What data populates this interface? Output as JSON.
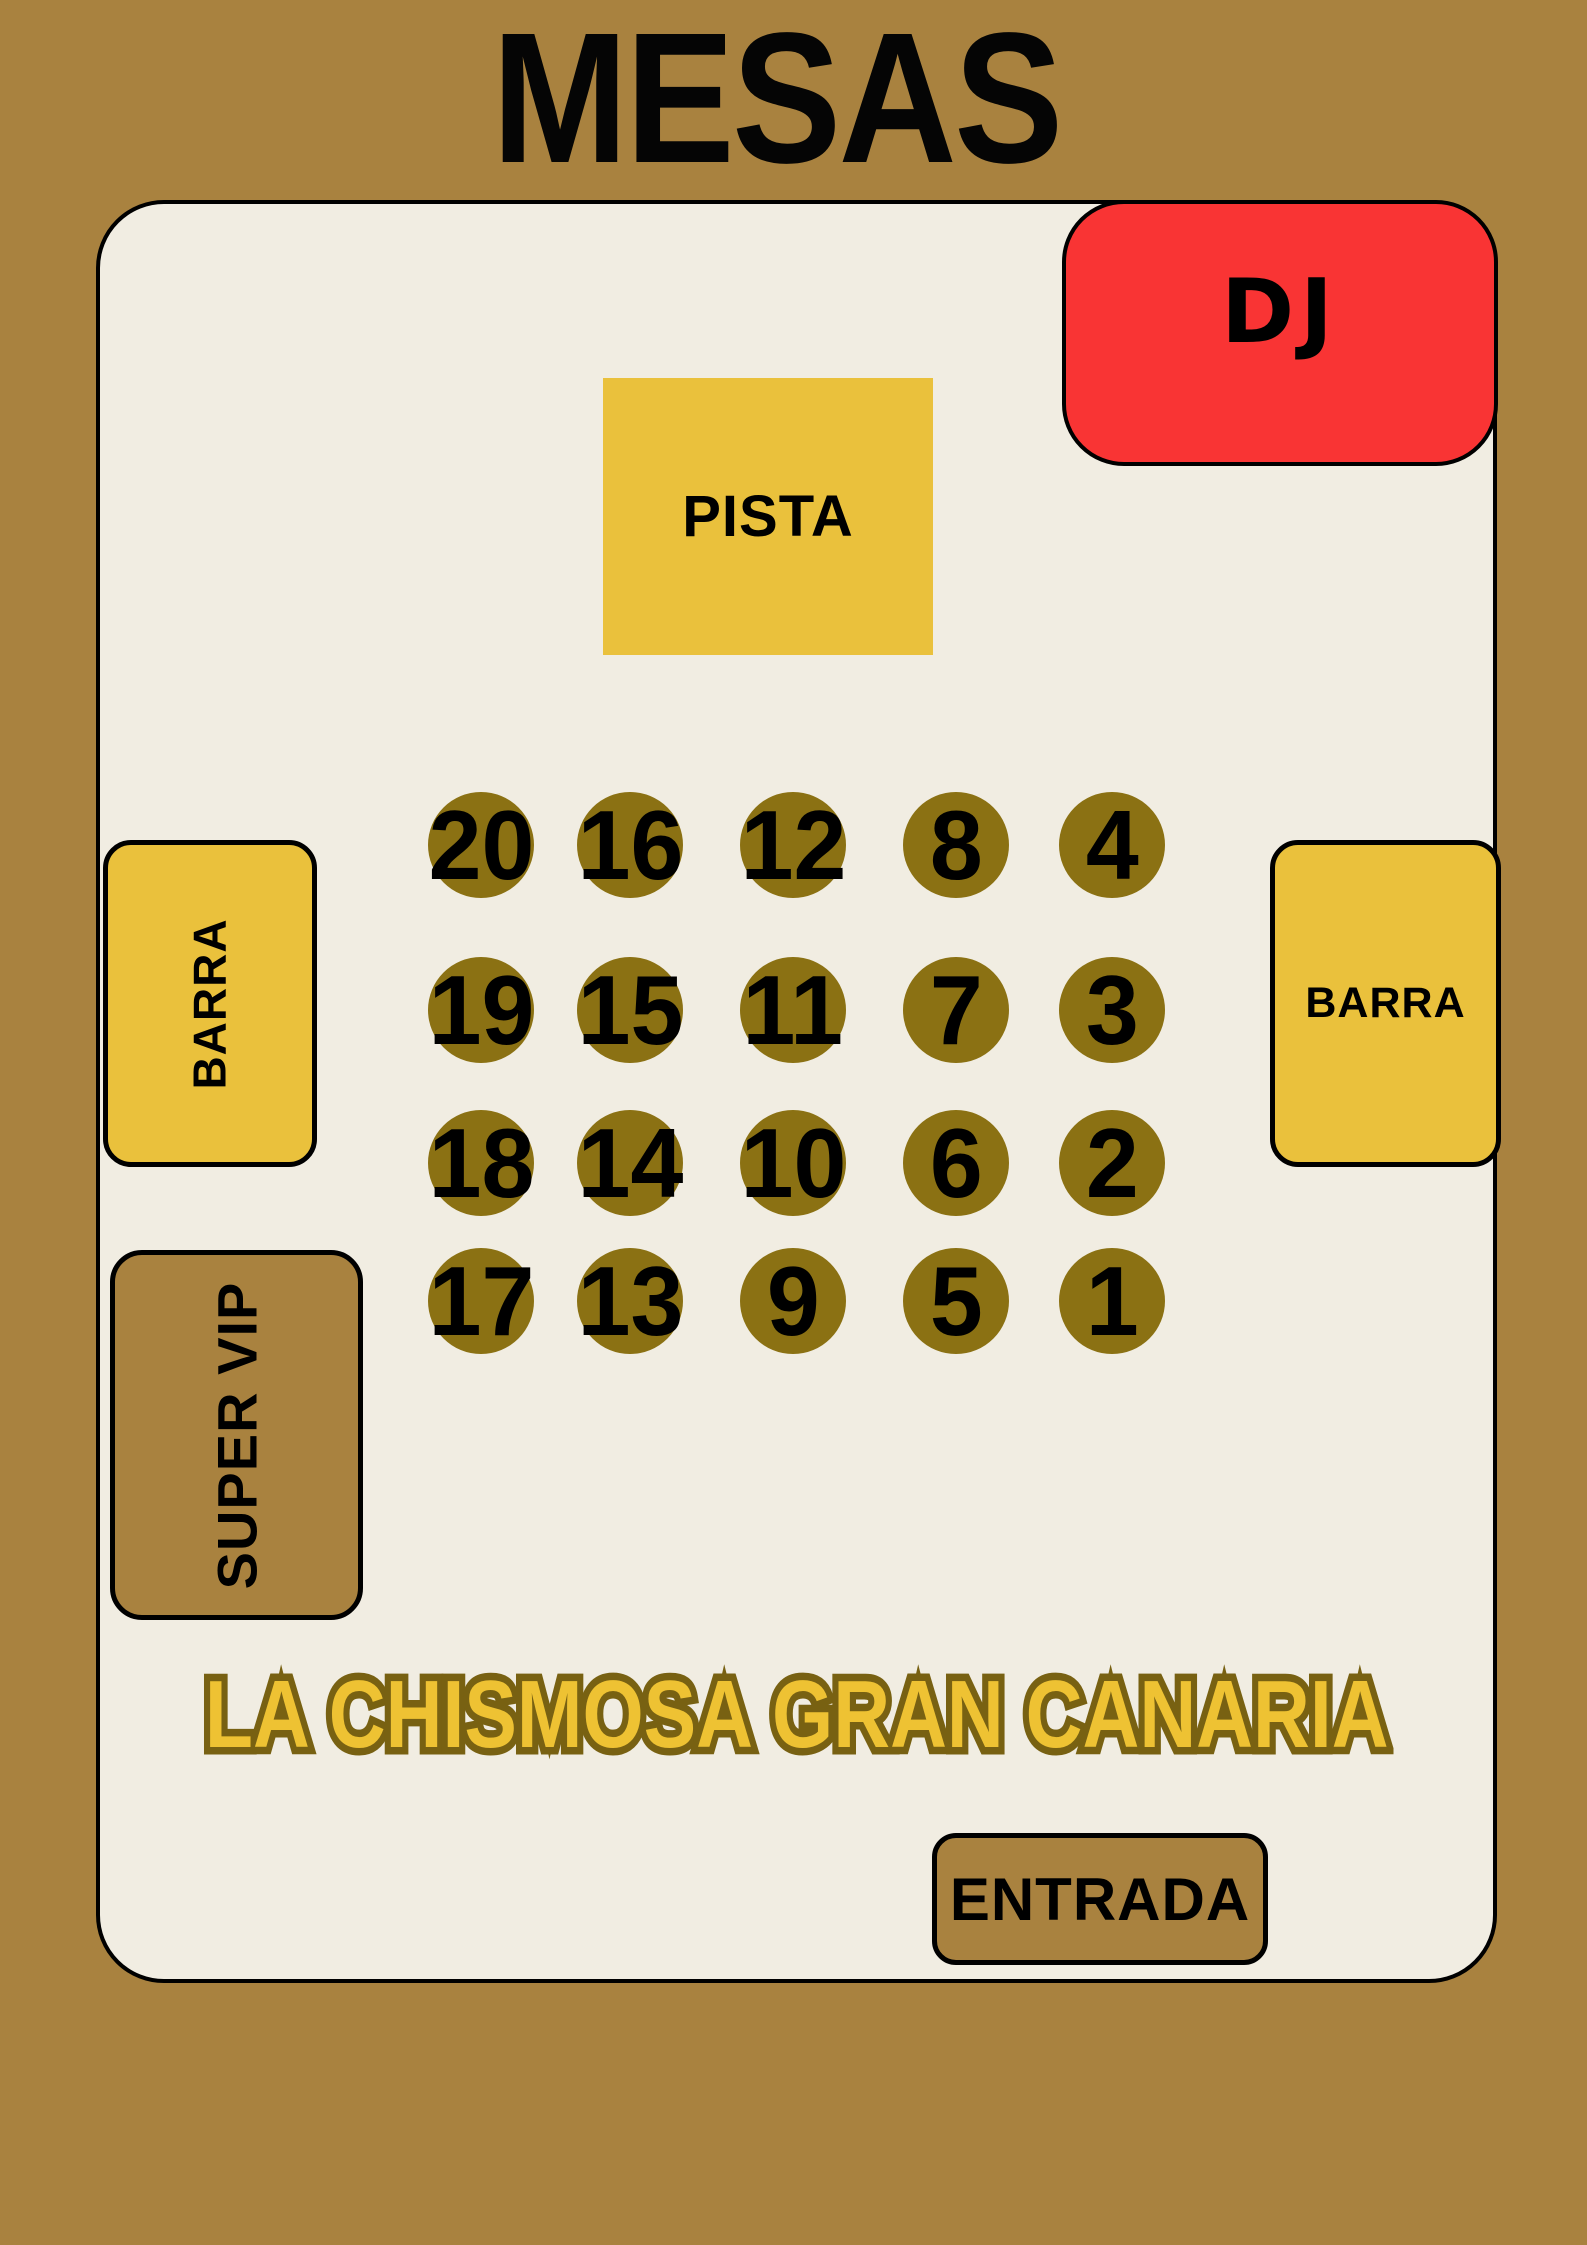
{
  "title": "MESAS",
  "venue": {
    "dj_label": "DJ",
    "pista_label": "PISTA",
    "barra_left_label": "BARRA",
    "barra_right_label": "BARRA",
    "super_vip_label": "SUPER VIP",
    "entrada_label": "ENTRADA",
    "brand_text": "LA CHISMOSA GRAN CANARIA"
  },
  "tables": {
    "rows": [
      [
        20,
        16,
        12,
        8,
        4
      ],
      [
        19,
        15,
        11,
        7,
        3
      ],
      [
        18,
        14,
        10,
        6,
        2
      ],
      [
        17,
        13,
        9,
        5,
        1
      ]
    ]
  },
  "colors": {
    "background_brown": "#A9823F",
    "floor_cream": "#F1EDE2",
    "accent_yellow": "#EAC13C",
    "dj_red": "#F93434",
    "table_olive": "#8B7113",
    "brand_gold_fill": "#EEC233",
    "brand_gold_outline": "#786112",
    "ink": "#000000"
  }
}
